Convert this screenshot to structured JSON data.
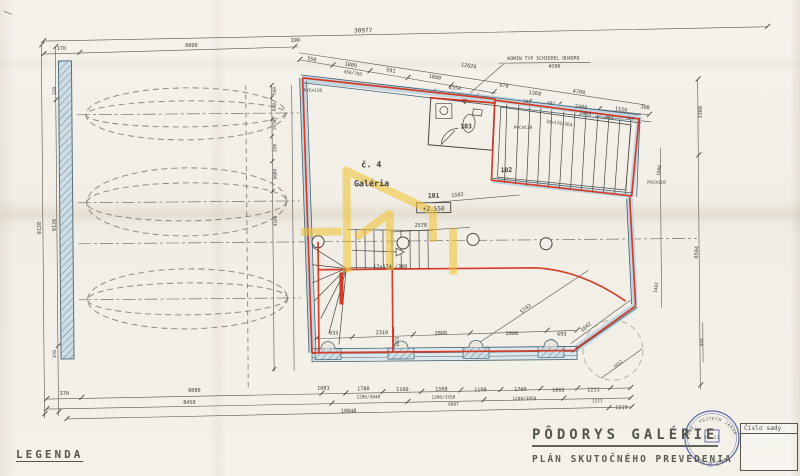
{
  "titles": {
    "legend": "LEGENDA",
    "title": "PÔDORYS GALÉRIE",
    "subtitle": "PLÁN SKUTOČNÉHO PREVEDENIA",
    "series_label": "Číslo sady"
  },
  "stamp": {
    "top": "ING. VOJTECH JAKAB",
    "bottom": "452-21-5-46",
    "center": "VA.11"
  },
  "unit": {
    "number": "č. 4",
    "name": "Galéria"
  },
  "rooms": {
    "r101": "101",
    "r101_level": "+2.550",
    "r102": "102",
    "r103": "103"
  },
  "notes": {
    "chimney": "KOMÍN TYP SCHIEDEL QUADRO",
    "chimney_size": "#200",
    "pvc1": "PVC∅110",
    "pvc2": "PVC∅110",
    "pvc3": "PVC∅110",
    "stair_right": "32×178/264",
    "stair_center": "17×174 /300"
  },
  "dims": {
    "top": [
      "30977",
      "370",
      "8000",
      "390",
      "550",
      "1809",
      "450/750",
      "591",
      "1880",
      "12626",
      "1554",
      "978",
      "193",
      "497",
      "1268",
      "4700",
      "2400",
      "2405",
      "433",
      "507",
      "1150",
      "308"
    ],
    "left": [
      "320",
      "9128",
      "9126",
      "370"
    ],
    "axis": [
      "560",
      "840",
      "1970",
      "250",
      "5009",
      "4328"
    ],
    "right": [
      "3309",
      "1600",
      "6504",
      "1482",
      "443",
      "1012"
    ],
    "inner": [
      "1582",
      "2578",
      "935",
      "2318",
      "2808",
      "2808",
      "693",
      "5742",
      "1042",
      "1075"
    ],
    "bottom": [
      "370",
      "8080",
      "1083",
      "1780",
      "1100",
      "1508",
      "1198",
      "1700",
      "1002",
      "1211",
      "8450",
      "1200/3840",
      "1200/3550",
      "8987",
      "1200/3850",
      "1211",
      "10848",
      "1219"
    ]
  }
}
